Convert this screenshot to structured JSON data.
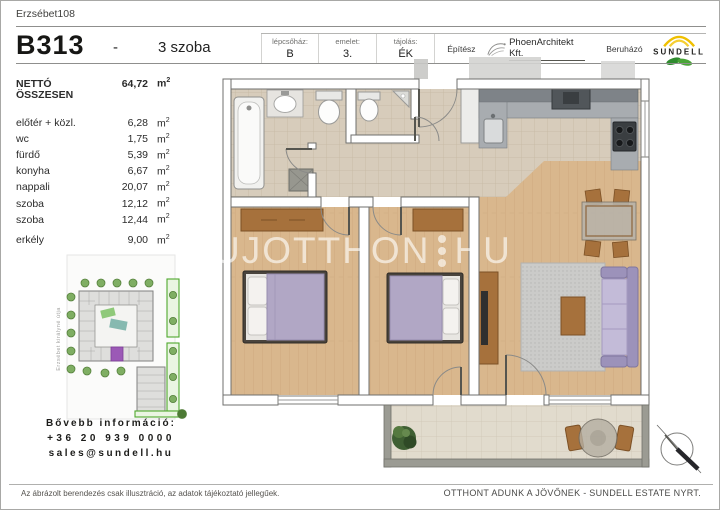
{
  "title": {
    "project": "Erzsébet108",
    "unit": "B313",
    "dash": "-",
    "rooms": "3 szoba"
  },
  "header": {
    "cols": [
      {
        "label": "lépcsőház:",
        "value": "B"
      },
      {
        "label": "emelet:",
        "value": "3."
      },
      {
        "label": "tájolás:",
        "value": "ÉK"
      }
    ],
    "architect_label": "Építész",
    "architect_name": "PhoenArchitekt Kft.",
    "developer_label": "Beruházó",
    "developer_name": "SUNDELL"
  },
  "areas": {
    "total_label": "NETTÓ ÖSSZESEN",
    "total_value": "64,72",
    "unit_base": "m",
    "unit_sup": "2",
    "rows": [
      {
        "name": "előtér + közl.",
        "value": "6,28"
      },
      {
        "name": "wc",
        "value": "1,75"
      },
      {
        "name": "fürdő",
        "value": "5,39"
      },
      {
        "name": "konyha",
        "value": "6,67"
      },
      {
        "name": "nappali",
        "value": "20,07"
      },
      {
        "name": "szoba",
        "value": "12,12"
      },
      {
        "name": "szoba",
        "value": "12,44"
      }
    ],
    "balcony": {
      "name": "erkély",
      "value": "9,00"
    }
  },
  "siteplan": {
    "street": "Erzsébet királyné útja"
  },
  "contact": {
    "heading": "Bővebb információ:",
    "phone": "+36 20 939 0000",
    "email": "sales@sundell.hu"
  },
  "watermark": {
    "left": "UJOTTHON",
    "right": "HU"
  },
  "footer": {
    "disclaimer": "Az ábrázolt berendezés csak illusztráció, az adatok tájékoztató jellegűek.",
    "slogan": "OTTHONT ADUNK A JÖVŐNEK - SUNDELL ESTATE NYRT."
  },
  "colors": {
    "accent_purple": "#9b59b6",
    "sundell_yellow": "#f0c000",
    "sundell_green": "#3a9a35",
    "wood_floor": "#d9b78d",
    "tile_floor": "#d7ccbb",
    "bed_purple": "#b1a7c5"
  }
}
